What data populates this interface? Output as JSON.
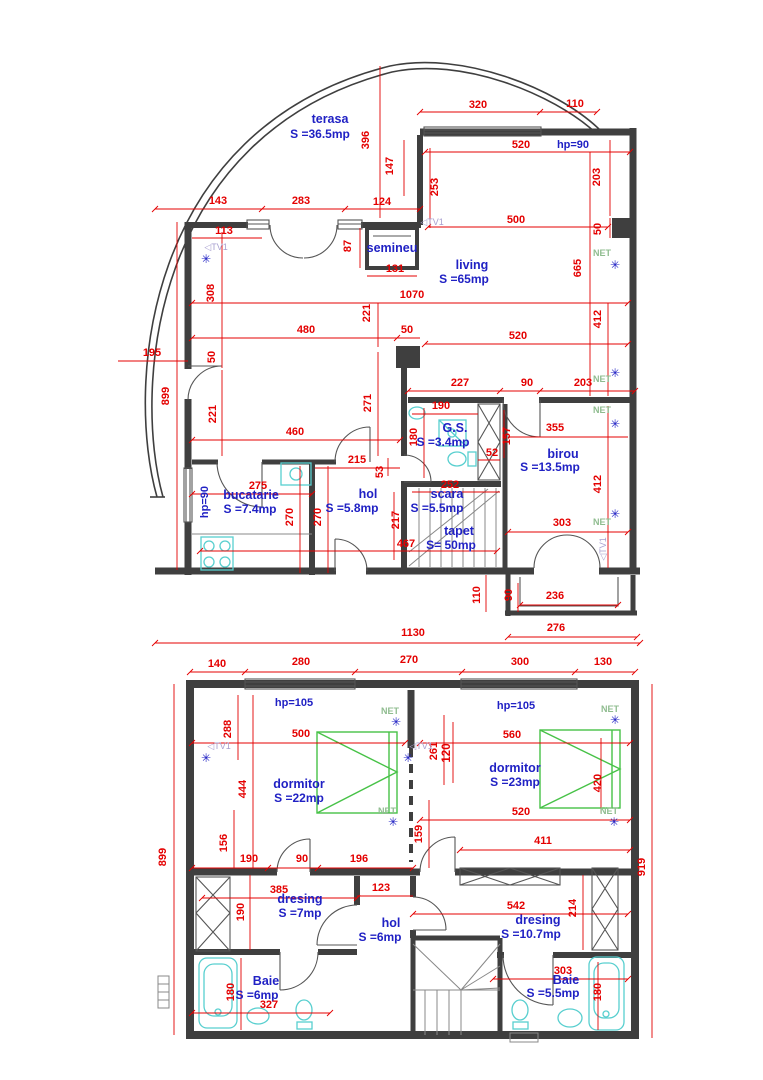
{
  "colors": {
    "wall": "#3f3f3f",
    "dimension_red": "#e40000",
    "label_blue": "#2021c4",
    "net_green": "#8fbc8f",
    "tv_violet": "#a79fd0",
    "fixture_cyan": "#58cfcf",
    "bed_green": "#47c247"
  },
  "floor1": {
    "rooms_summary": [
      {
        "name": "terasa",
        "area": "S =36.5mp"
      },
      {
        "name": "living",
        "area": "S =65mp"
      },
      {
        "name": "semineu",
        "area": ""
      },
      {
        "name": "bucatarie",
        "area": "S =7.4mp"
      },
      {
        "name": "hol",
        "area": "S =5.8mp"
      },
      {
        "name": "G.S.",
        "area": "S =3.4mp"
      },
      {
        "name": "scara",
        "area": "S =5.5mp"
      },
      {
        "name": "tapet",
        "area": "S= 50mp"
      },
      {
        "name": "birou",
        "area": "S =13.5mp"
      }
    ],
    "labels": [
      {
        "t": "terasa",
        "k": "room",
        "x": 330,
        "y": 123
      },
      {
        "t": "S =36.5mp",
        "k": "area",
        "x": 320,
        "y": 138
      },
      {
        "t": "living",
        "k": "room",
        "x": 472,
        "y": 269
      },
      {
        "t": "S =65mp",
        "k": "area",
        "x": 464,
        "y": 283
      },
      {
        "t": "semineu",
        "k": "room",
        "x": 392,
        "y": 252
      },
      {
        "t": "bucatarie",
        "k": "room",
        "x": 251,
        "y": 499
      },
      {
        "t": "S =7.4mp",
        "k": "area",
        "x": 250,
        "y": 513
      },
      {
        "t": "hol",
        "k": "room",
        "x": 368,
        "y": 498
      },
      {
        "t": "S =5.8mp",
        "k": "area",
        "x": 352,
        "y": 512
      },
      {
        "t": "G.S.",
        "k": "room",
        "x": 455,
        "y": 432
      },
      {
        "t": "S =3.4mp",
        "k": "area",
        "x": 443,
        "y": 446
      },
      {
        "t": "scara",
        "k": "room",
        "x": 447,
        "y": 498
      },
      {
        "t": "S =5.5mp",
        "k": "area",
        "x": 437,
        "y": 512
      },
      {
        "t": "tapet",
        "k": "room",
        "x": 459,
        "y": 535
      },
      {
        "t": "S= 50mp",
        "k": "area",
        "x": 451,
        "y": 549
      },
      {
        "t": "birou",
        "k": "room",
        "x": 563,
        "y": 458
      },
      {
        "t": "S =13.5mp",
        "k": "area",
        "x": 550,
        "y": 471
      },
      {
        "t": "hp=90",
        "k": "hp",
        "x": 573,
        "y": 148
      },
      {
        "t": "hp=90",
        "k": "hp",
        "x": 208,
        "y": 502,
        "r": -90
      },
      {
        "t": "320",
        "k": "dim",
        "x": 478,
        "y": 108
      },
      {
        "t": "110",
        "k": "dim",
        "x": 575,
        "y": 107
      },
      {
        "t": "520",
        "k": "dim",
        "x": 521,
        "y": 148
      },
      {
        "t": "396",
        "k": "dim",
        "x": 369,
        "y": 140,
        "r": -90
      },
      {
        "t": "147",
        "k": "dim",
        "x": 393,
        "y": 166,
        "r": -90
      },
      {
        "t": "253",
        "k": "dim",
        "x": 438,
        "y": 187,
        "r": -90
      },
      {
        "t": "203",
        "k": "dim",
        "x": 600,
        "y": 177,
        "r": -90
      },
      {
        "t": "500",
        "k": "dim",
        "x": 516,
        "y": 223
      },
      {
        "t": "50",
        "k": "dim",
        "x": 601,
        "y": 229,
        "r": -90
      },
      {
        "t": "665",
        "k": "dim",
        "x": 581,
        "y": 268,
        "r": -90
      },
      {
        "t": "143",
        "k": "dim",
        "x": 218,
        "y": 204
      },
      {
        "t": "283",
        "k": "dim",
        "x": 301,
        "y": 204
      },
      {
        "t": "124",
        "k": "dim",
        "x": 382,
        "y": 205
      },
      {
        "t": "113",
        "k": "dim",
        "x": 224,
        "y": 234
      },
      {
        "t": "87",
        "k": "dim",
        "x": 351,
        "y": 246,
        "r": -90
      },
      {
        "t": "131",
        "k": "dim",
        "x": 395,
        "y": 272
      },
      {
        "t": "308",
        "k": "dim",
        "x": 214,
        "y": 293,
        "r": -90
      },
      {
        "t": "1070",
        "k": "dim",
        "x": 412,
        "y": 298
      },
      {
        "t": "221",
        "k": "dim",
        "x": 370,
        "y": 313,
        "r": -90
      },
      {
        "t": "412",
        "k": "dim",
        "x": 601,
        "y": 319,
        "r": -90
      },
      {
        "t": "480",
        "k": "dim",
        "x": 306,
        "y": 333
      },
      {
        "t": "50",
        "k": "dim",
        "x": 407,
        "y": 333
      },
      {
        "t": "520",
        "k": "dim",
        "x": 518,
        "y": 339
      },
      {
        "t": "195",
        "k": "dim",
        "x": 152,
        "y": 356
      },
      {
        "t": "899",
        "k": "dim",
        "x": 169,
        "y": 396,
        "r": -90
      },
      {
        "t": "50",
        "k": "dim",
        "x": 215,
        "y": 357,
        "r": -90
      },
      {
        "t": "221",
        "k": "dim",
        "x": 216,
        "y": 414,
        "r": -90
      },
      {
        "t": "460",
        "k": "dim",
        "x": 295,
        "y": 435
      },
      {
        "t": "271",
        "k": "dim",
        "x": 371,
        "y": 403,
        "r": -90
      },
      {
        "t": "227",
        "k": "dim",
        "x": 460,
        "y": 386
      },
      {
        "t": "90",
        "k": "dim",
        "x": 527,
        "y": 386
      },
      {
        "t": "203",
        "k": "dim",
        "x": 583,
        "y": 386
      },
      {
        "t": "190",
        "k": "dim",
        "x": 441,
        "y": 409
      },
      {
        "t": "180",
        "k": "dim",
        "x": 417,
        "y": 437,
        "r": -90
      },
      {
        "t": "157",
        "k": "dim",
        "x": 510,
        "y": 436,
        "r": -90
      },
      {
        "t": "52",
        "k": "dim",
        "x": 492,
        "y": 456
      },
      {
        "t": "355",
        "k": "dim",
        "x": 555,
        "y": 431
      },
      {
        "t": "412",
        "k": "dim",
        "x": 601,
        "y": 484,
        "r": -90
      },
      {
        "t": "215",
        "k": "dim",
        "x": 357,
        "y": 463
      },
      {
        "t": "53",
        "k": "dim",
        "x": 383,
        "y": 472,
        "r": -90
      },
      {
        "t": "275",
        "k": "dim",
        "x": 258,
        "y": 489
      },
      {
        "t": "270",
        "k": "dim",
        "x": 293,
        "y": 517,
        "r": -90
      },
      {
        "t": "270",
        "k": "dim",
        "x": 321,
        "y": 517,
        "r": -90
      },
      {
        "t": "252",
        "k": "dim",
        "x": 450,
        "y": 488
      },
      {
        "t": "217",
        "k": "dim",
        "x": 399,
        "y": 520,
        "r": -90
      },
      {
        "t": "467",
        "k": "dim",
        "x": 406,
        "y": 547
      },
      {
        "t": "303",
        "k": "dim",
        "x": 562,
        "y": 526
      },
      {
        "t": "110",
        "k": "dim",
        "x": 480,
        "y": 595,
        "r": -90
      },
      {
        "t": "90",
        "k": "dim",
        "x": 512,
        "y": 595,
        "r": -90
      },
      {
        "t": "236",
        "k": "dim",
        "x": 555,
        "y": 599
      },
      {
        "t": "276",
        "k": "dim",
        "x": 556,
        "y": 631
      },
      {
        "t": "1130",
        "k": "dim",
        "x": 413,
        "y": 636
      },
      {
        "t": "NET",
        "k": "net",
        "x": 602,
        "y": 256
      },
      {
        "t": "NET",
        "k": "net",
        "x": 602,
        "y": 382
      },
      {
        "t": "NET",
        "k": "net",
        "x": 602,
        "y": 413
      },
      {
        "t": "NET",
        "k": "net",
        "x": 602,
        "y": 525
      },
      {
        "t": "✳",
        "k": "star",
        "x": 615,
        "y": 269
      },
      {
        "t": "✳",
        "k": "star",
        "x": 615,
        "y": 377
      },
      {
        "t": "✳",
        "k": "star",
        "x": 615,
        "y": 428
      },
      {
        "t": "✳",
        "k": "star",
        "x": 615,
        "y": 518
      },
      {
        "t": "◁TV1",
        "k": "tv",
        "x": 216,
        "y": 250
      },
      {
        "t": "◁TV1",
        "k": "tv",
        "x": 432,
        "y": 225
      },
      {
        "t": "◁TV1",
        "k": "tv",
        "x": 606,
        "y": 549,
        "r": -90
      },
      {
        "t": "✳",
        "k": "star",
        "x": 206,
        "y": 263
      }
    ]
  },
  "floor2": {
    "rooms_summary": [
      {
        "name": "dormitor",
        "area": "S =22mp"
      },
      {
        "name": "dormitor",
        "area": "S =23mp"
      },
      {
        "name": "dresing",
        "area": "S =7mp"
      },
      {
        "name": "hol",
        "area": "S =6mp"
      },
      {
        "name": "dresing",
        "area": "S =10.7mp"
      },
      {
        "name": "Baie",
        "area": "S =6mp"
      },
      {
        "name": "Baie",
        "area": "S =5.5mp"
      }
    ],
    "labels": [
      {
        "t": "dormitor",
        "k": "room",
        "x": 299,
        "y": 788
      },
      {
        "t": "S =22mp",
        "k": "area",
        "x": 299,
        "y": 802
      },
      {
        "t": "dormitor",
        "k": "room",
        "x": 515,
        "y": 772
      },
      {
        "t": "S =23mp",
        "k": "area",
        "x": 515,
        "y": 786
      },
      {
        "t": "dresing",
        "k": "room",
        "x": 300,
        "y": 903
      },
      {
        "t": "S =7mp",
        "k": "area",
        "x": 300,
        "y": 917
      },
      {
        "t": "hol",
        "k": "room",
        "x": 391,
        "y": 927
      },
      {
        "t": "S =6mp",
        "k": "area",
        "x": 380,
        "y": 941
      },
      {
        "t": "dresing",
        "k": "room",
        "x": 538,
        "y": 924
      },
      {
        "t": "S =10.7mp",
        "k": "area",
        "x": 531,
        "y": 938
      },
      {
        "t": "Baie",
        "k": "room",
        "x": 266,
        "y": 985
      },
      {
        "t": "S =6mp",
        "k": "area",
        "x": 257,
        "y": 999
      },
      {
        "t": "Baie",
        "k": "room",
        "x": 566,
        "y": 984
      },
      {
        "t": "S =5.5mp",
        "k": "area",
        "x": 553,
        "y": 997
      },
      {
        "t": "hp=105",
        "k": "hp",
        "x": 294,
        "y": 706
      },
      {
        "t": "hp=105",
        "k": "hp",
        "x": 516,
        "y": 709
      },
      {
        "t": "140",
        "k": "dim",
        "x": 217,
        "y": 667
      },
      {
        "t": "280",
        "k": "dim",
        "x": 301,
        "y": 665
      },
      {
        "t": "270",
        "k": "dim",
        "x": 409,
        "y": 663
      },
      {
        "t": "300",
        "k": "dim",
        "x": 520,
        "y": 665
      },
      {
        "t": "130",
        "k": "dim",
        "x": 603,
        "y": 665
      },
      {
        "t": "899",
        "k": "dim",
        "x": 166,
        "y": 857,
        "r": -90
      },
      {
        "t": "919",
        "k": "dim",
        "x": 645,
        "y": 867,
        "r": -90
      },
      {
        "t": "288",
        "k": "dim",
        "x": 231,
        "y": 729,
        "r": -90
      },
      {
        "t": "500",
        "k": "dim",
        "x": 301,
        "y": 737
      },
      {
        "t": "560",
        "k": "dim",
        "x": 512,
        "y": 738
      },
      {
        "t": "261",
        "k": "dim",
        "x": 437,
        "y": 751,
        "r": -90
      },
      {
        "t": "120",
        "k": "dimb",
        "x": 450,
        "y": 753,
        "r": -90
      },
      {
        "t": "444",
        "k": "dim",
        "x": 246,
        "y": 789,
        "r": -90
      },
      {
        "t": "420",
        "k": "dim",
        "x": 601,
        "y": 783,
        "r": -90
      },
      {
        "t": "156",
        "k": "dim",
        "x": 227,
        "y": 843,
        "r": -90
      },
      {
        "t": "159",
        "k": "dim",
        "x": 422,
        "y": 834,
        "r": -90
      },
      {
        "t": "190",
        "k": "dim",
        "x": 249,
        "y": 862
      },
      {
        "t": "90",
        "k": "dim",
        "x": 302,
        "y": 862
      },
      {
        "t": "196",
        "k": "dim",
        "x": 359,
        "y": 862
      },
      {
        "t": "520",
        "k": "dim",
        "x": 521,
        "y": 815
      },
      {
        "t": "411",
        "k": "dim",
        "x": 543,
        "y": 844
      },
      {
        "t": "385",
        "k": "dim",
        "x": 279,
        "y": 893
      },
      {
        "t": "123",
        "k": "dim",
        "x": 381,
        "y": 891
      },
      {
        "t": "190",
        "k": "dim",
        "x": 244,
        "y": 912,
        "r": -90
      },
      {
        "t": "542",
        "k": "dim",
        "x": 516,
        "y": 909
      },
      {
        "t": "214",
        "k": "dim",
        "x": 576,
        "y": 908,
        "r": -90
      },
      {
        "t": "180",
        "k": "dim",
        "x": 234,
        "y": 992,
        "r": -90
      },
      {
        "t": "327",
        "k": "dim",
        "x": 269,
        "y": 1008
      },
      {
        "t": "303",
        "k": "dim",
        "x": 563,
        "y": 974
      },
      {
        "t": "180",
        "k": "dim",
        "x": 601,
        "y": 992,
        "r": -90
      },
      {
        "t": "NET",
        "k": "net",
        "x": 390,
        "y": 714
      },
      {
        "t": "NET",
        "k": "net",
        "x": 387,
        "y": 814
      },
      {
        "t": "NET",
        "k": "net",
        "x": 610,
        "y": 712
      },
      {
        "t": "NET",
        "k": "net",
        "x": 609,
        "y": 814
      },
      {
        "t": "✳",
        "k": "star",
        "x": 396,
        "y": 726
      },
      {
        "t": "✳",
        "k": "star",
        "x": 393,
        "y": 826
      },
      {
        "t": "✳",
        "k": "star",
        "x": 615,
        "y": 724
      },
      {
        "t": "✳",
        "k": "star",
        "x": 614,
        "y": 826
      },
      {
        "t": "◁TV1",
        "k": "tv",
        "x": 219,
        "y": 749
      },
      {
        "t": "◁TV1",
        "k": "tv",
        "x": 421,
        "y": 749
      },
      {
        "t": "✳",
        "k": "star",
        "x": 206,
        "y": 762
      },
      {
        "t": "✳",
        "k": "star",
        "x": 408,
        "y": 762
      }
    ]
  }
}
